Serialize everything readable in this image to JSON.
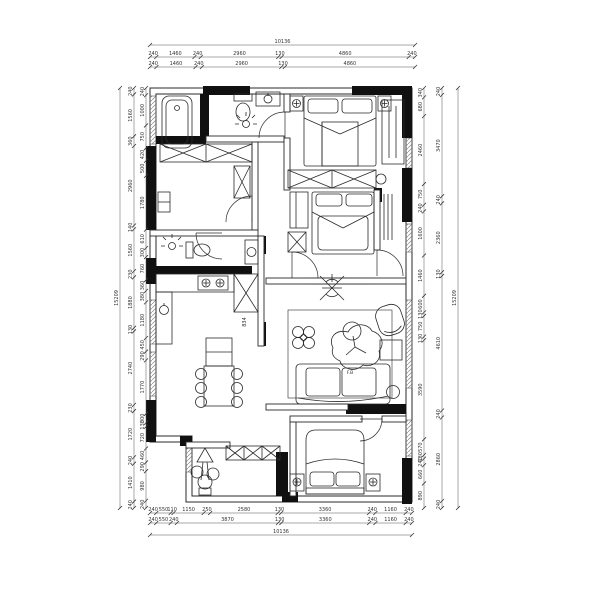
{
  "drawing": {
    "type": "residential floor plan, CAD line drawing",
    "line_color": "#2a2a2a",
    "wall_fill": "#101010",
    "background": "#ffffff"
  },
  "dimensions": {
    "top": {
      "overall": "10136",
      "row1": [
        "240",
        "1460",
        "240",
        "2960",
        "130",
        "4860",
        "240"
      ],
      "row2": [
        "240",
        "1460",
        "240",
        "2960",
        "130",
        "4860"
      ]
    },
    "bottom": {
      "overall": "10136",
      "row1": [
        "240",
        "550",
        "110",
        "1150",
        "250",
        "2580",
        "130",
        "3360",
        "240",
        "1160",
        "240"
      ],
      "row2": [
        "240",
        "550",
        "240",
        "3870",
        "130",
        "3360",
        "240",
        "1160",
        "240"
      ]
    },
    "left": {
      "overall": "15209",
      "outer": [
        "240",
        "1560",
        "360",
        "2960",
        "140",
        "1560",
        "230",
        "1880",
        "130",
        "2740",
        "230",
        "1720",
        "240",
        "1410",
        "240"
      ],
      "inner": [
        "240",
        "1000",
        "750",
        "420",
        "500",
        "1780",
        "610",
        "300",
        "760",
        "360",
        "380",
        "1180",
        "450",
        "290",
        "1770",
        "300",
        "130",
        "720",
        "460",
        "290",
        "980",
        "240"
      ]
    },
    "right": {
      "overall": "15209",
      "outer": [
        "240",
        "3470",
        "240",
        "2360",
        "130",
        "4610",
        "240",
        "2860",
        "240"
      ],
      "inner": [
        "340",
        "680",
        "2460",
        "750",
        "240",
        "1600",
        "1460",
        "600",
        "130",
        "750",
        "130",
        "3590",
        "570",
        "130",
        "240",
        "660",
        "890"
      ]
    }
  },
  "plan": {
    "labels": {
      "cabinet_code": "834",
      "chair_code": "F.B"
    }
  }
}
